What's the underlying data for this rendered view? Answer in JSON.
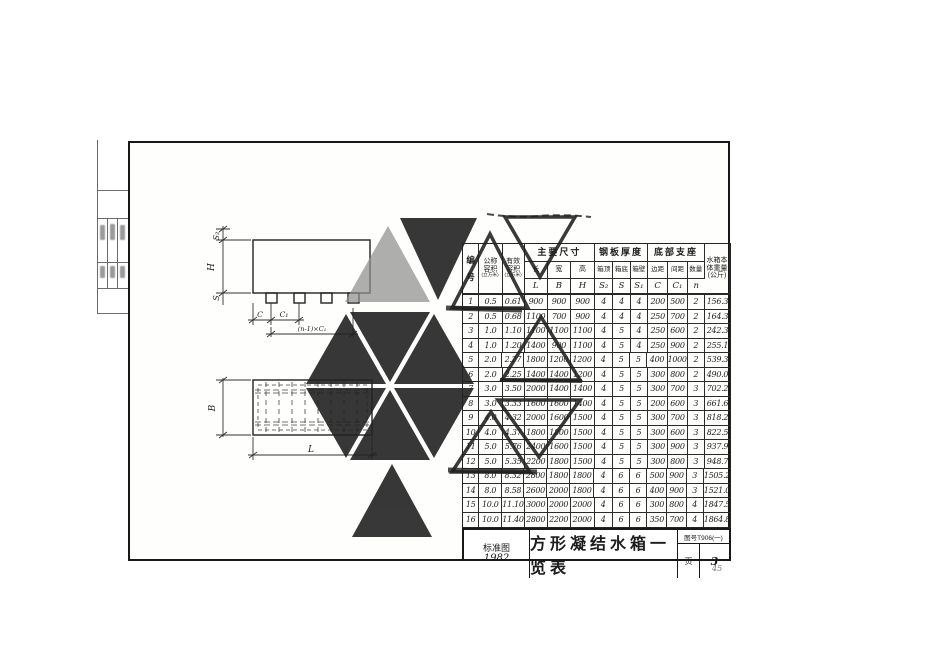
{
  "page": {
    "page_number": "45",
    "paper_color": "#fefefc",
    "ink_color": "#1c1c1c",
    "stamp_color": "#222222"
  },
  "drawing": {
    "front": {
      "s2": "S₂",
      "h": "H",
      "s": "S",
      "c": "C",
      "c1": "C₁",
      "nc1": "(n-1)×C₁"
    },
    "plan": {
      "b": "B",
      "l": "L"
    }
  },
  "table": {
    "header": {
      "no": [
        "编",
        "号"
      ],
      "nominal": [
        "公称",
        "容积",
        "(立方米)"
      ],
      "effective": [
        "有效",
        "容积",
        "(立方米)"
      ],
      "dims_group": "主要尺寸",
      "dims_sub": [
        "长",
        "宽",
        "高"
      ],
      "dims_sym": [
        "L",
        "B",
        "H"
      ],
      "thick_group": "钢板厚度",
      "thick_sub": [
        "箱顶",
        "箱底",
        "箱壁"
      ],
      "thick_sym": [
        "S₂",
        "S",
        "S₁"
      ],
      "support_group": "底部支座",
      "support_sub": [
        "边距",
        "间距",
        "数量"
      ],
      "support_sym": [
        "C",
        "C₁",
        "n"
      ],
      "weight": [
        "水箱本",
        "体重量",
        "(公斤)"
      ]
    },
    "rows": [
      [
        "1",
        "0.5",
        "0.61",
        "900",
        "900",
        "900",
        "4",
        "4",
        "4",
        "200",
        "500",
        "2",
        "156.3"
      ],
      [
        "2",
        "0.5",
        "0.68",
        "1100",
        "700",
        "900",
        "4",
        "4",
        "4",
        "250",
        "700",
        "2",
        "164.3"
      ],
      [
        "3",
        "1.0",
        "1.10",
        "1100",
        "1100",
        "1100",
        "4",
        "5",
        "4",
        "250",
        "600",
        "2",
        "242.3"
      ],
      [
        "4",
        "1.0",
        "1.20",
        "1400",
        "900",
        "1100",
        "4",
        "5",
        "4",
        "250",
        "900",
        "2",
        "255.1"
      ],
      [
        "5",
        "2.0",
        "2.27",
        "1800",
        "1200",
        "1200",
        "4",
        "5",
        "5",
        "400",
        "1000",
        "2",
        "539.3"
      ],
      [
        "6",
        "2.0",
        "2.25",
        "1400",
        "1400",
        "1200",
        "4",
        "5",
        "5",
        "300",
        "800",
        "2",
        "490.0"
      ],
      [
        "7",
        "3.0",
        "3.50",
        "2000",
        "1400",
        "1400",
        "4",
        "5",
        "5",
        "300",
        "700",
        "3",
        "702.2"
      ],
      [
        "8",
        "3.0",
        "3.33",
        "1600",
        "1600",
        "1400",
        "4",
        "5",
        "5",
        "200",
        "600",
        "3",
        "661.6"
      ],
      [
        "9",
        "4.0",
        "4.32",
        "2000",
        "1600",
        "1500",
        "4",
        "5",
        "5",
        "300",
        "700",
        "3",
        "818.2"
      ],
      [
        "10",
        "4.0",
        "4.37",
        "1800",
        "1800",
        "1500",
        "4",
        "5",
        "5",
        "300",
        "600",
        "3",
        "822.5"
      ],
      [
        "11",
        "5.0",
        "5.76",
        "2400",
        "1600",
        "1500",
        "4",
        "5",
        "5",
        "300",
        "900",
        "3",
        "937.9"
      ],
      [
        "12",
        "5.0",
        "5.35",
        "2200",
        "1800",
        "1500",
        "4",
        "5",
        "5",
        "300",
        "800",
        "3",
        "948.7"
      ],
      [
        "13",
        "8.0",
        "8.32",
        "2800",
        "1800",
        "1800",
        "4",
        "6",
        "6",
        "500",
        "900",
        "3",
        "1505.2"
      ],
      [
        "14",
        "8.0",
        "8.58",
        "2600",
        "2000",
        "1800",
        "4",
        "6",
        "6",
        "400",
        "900",
        "3",
        "1521.0"
      ],
      [
        "15",
        "10.0",
        "11.10",
        "3000",
        "2000",
        "2000",
        "4",
        "6",
        "6",
        "300",
        "800",
        "4",
        "1847.5"
      ],
      [
        "16",
        "10.0",
        "11.40",
        "2800",
        "2200",
        "2000",
        "4",
        "6",
        "6",
        "350",
        "700",
        "4",
        "1864.8"
      ]
    ]
  },
  "titlebar": {
    "std_label": "标准图",
    "std_year": "1982",
    "title": "方形凝结水箱一览表",
    "doc_no": "图号T906(一)",
    "page_label": "页",
    "page_no": "3"
  }
}
